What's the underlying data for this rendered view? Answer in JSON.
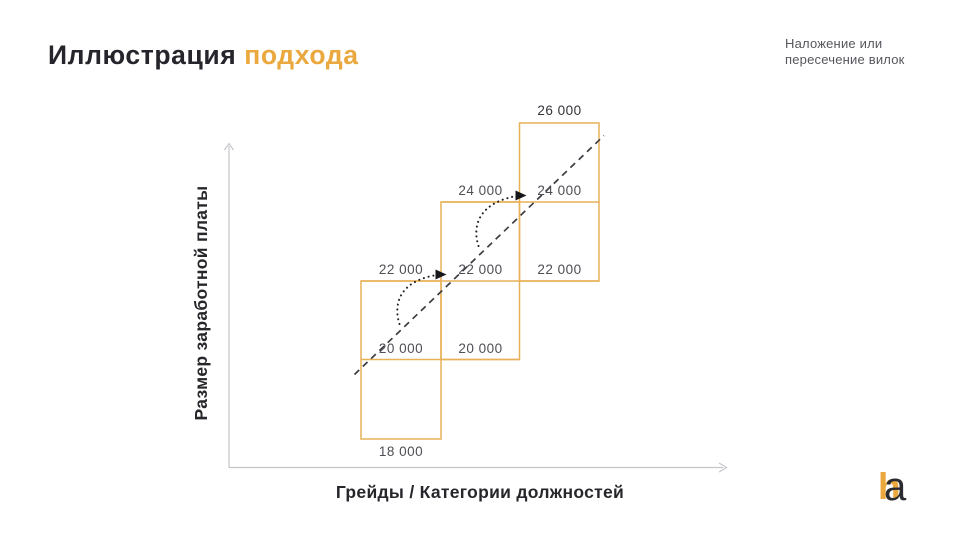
{
  "slide": {
    "title": {
      "main": "Иллюстрация",
      "accent": "подхода"
    },
    "note": {
      "line1": "Наложение или",
      "line2": "пересечение вилок"
    },
    "logo": {
      "h": "h",
      "a": "a"
    }
  },
  "chart": {
    "ylabel": "Размер заработной платы",
    "xlabel": "Грейды / Категории должностей",
    "value_labels": {
      "v18": "18 000",
      "v20": "20 000",
      "v22": "22 000",
      "v24": "24 000",
      "v26": "26 000"
    }
  },
  "chart_data": {
    "type": "range-bar",
    "title": "Иллюстрация подхода",
    "annotation": "Наложение или пересечение вилок",
    "xlabel": "Грейды / Категории должностей",
    "ylabel": "Размер заработной платы",
    "series": [
      {
        "range": [
          18000,
          22000
        ]
      },
      {
        "range": [
          20000,
          24000
        ]
      },
      {
        "range": [
          22000,
          26000
        ]
      }
    ],
    "labeled_levels": [
      18000,
      20000,
      22000,
      24000,
      26000
    ],
    "overlap_step": 2000,
    "ylim": [
      18000,
      26000
    ],
    "extras": {
      "trend_line": "dashed diagonal ascending through all three ranges",
      "arrows": "dotted curved arrows from range 1 to range 2 and from range 2 to range 3"
    },
    "colors": {
      "box_stroke": "#e8b158",
      "accent": "#eaa83e",
      "value_text": "#4e4e55",
      "dark_text": "#25252b",
      "axis": "#c6c6ca"
    }
  }
}
